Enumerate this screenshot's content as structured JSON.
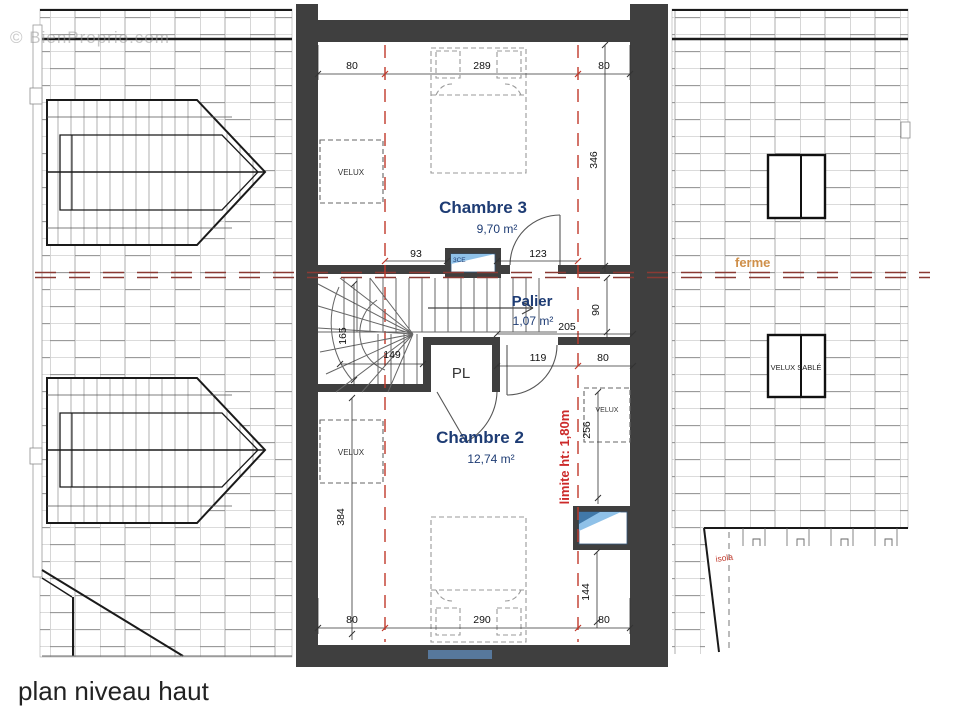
{
  "watermark": "© BienProprio.com",
  "title": "plan niveau haut",
  "rooms": {
    "chambre3": {
      "name": "Chambre 3",
      "area": "9,70 m²"
    },
    "palier": {
      "name": "Palier",
      "area": "1,07 m²"
    },
    "chambre2": {
      "name": "Chambre 2",
      "area": "12,74 m²"
    },
    "closet": {
      "name": "PL"
    }
  },
  "annotations": {
    "ferme": "ferme",
    "limite": "limite ht: 1,80m",
    "velux_left_top": "VELUX",
    "velux_left_bottom": "VELUX",
    "velux_right_inner": "VELUX",
    "velux_sable": "VELUX SABLÉ",
    "isola": "isola",
    "window_ref": "3CE"
  },
  "dimensions": {
    "top": [
      "80",
      "289",
      "80"
    ],
    "bottom": [
      "80",
      "290",
      "80"
    ],
    "chambre3_height": "346",
    "chambre3_bottom": [
      "93",
      "123"
    ],
    "palier_side": "90",
    "palier_width": "205",
    "chambre2_top": [
      "119",
      "80"
    ],
    "stair_depth": "165",
    "stair_width": "149",
    "chambre2_side": "384",
    "velux_right": "256",
    "bottom_right": "144"
  },
  "colors": {
    "wall": "#3f3f3f",
    "limite_red": "#c0392b",
    "ferme_line": "#8a3a34",
    "ferme_text": "#cf8f49",
    "room_text": "#1e3c74",
    "glass_blue": "#8fc1e8",
    "window_strip_blue": "#57789c"
  }
}
